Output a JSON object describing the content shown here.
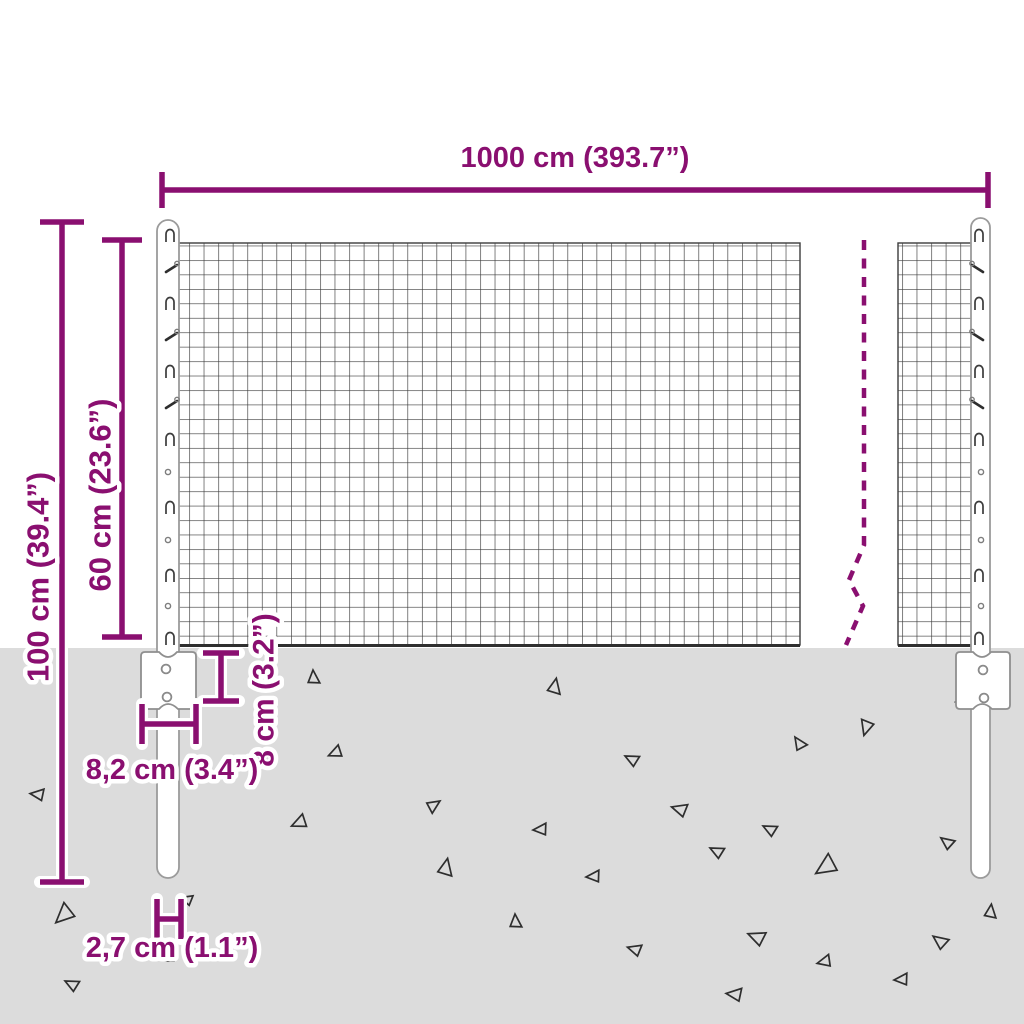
{
  "title": "Wire mesh fence dimension diagram",
  "accent_color": "#8A0F70",
  "ground_color": "#DCDCDC",
  "mesh_line_color": "#3c3c3c",
  "dimensions": {
    "total_width": "1000 cm (393.7”)",
    "total_height": "100 cm (39.4”)",
    "mesh_height": "60 cm (23.6”)",
    "anchor_plate_height": "8 cm (3.2”)",
    "anchor_plate_width": "8,2 cm (3.4”)",
    "post_diameter": "2,7 cm (1.1”)"
  }
}
